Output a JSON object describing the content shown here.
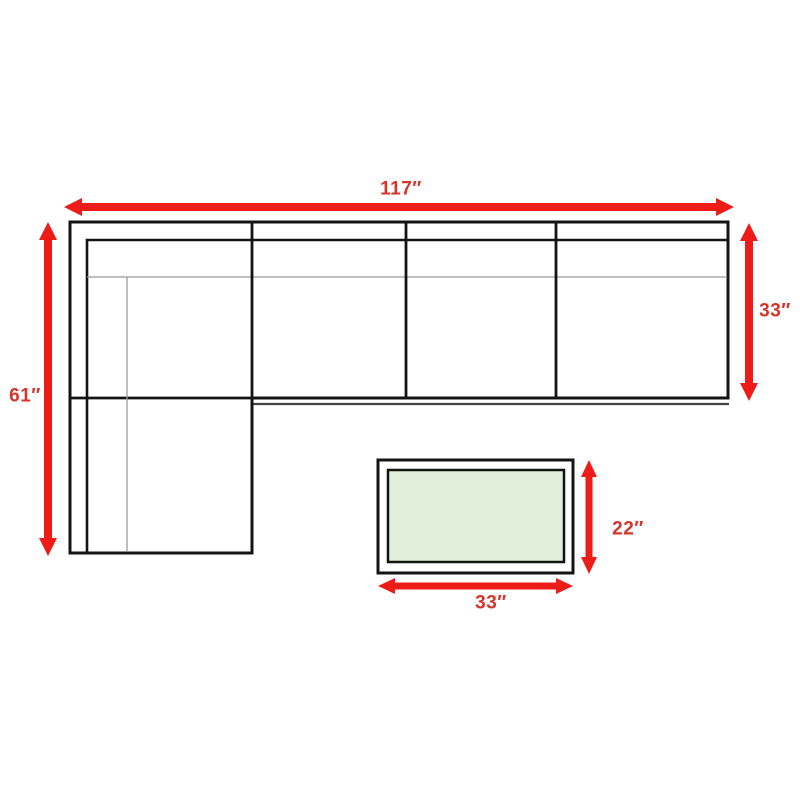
{
  "diagram": {
    "type": "furniture-dimension-diagram",
    "view": "top-down",
    "sofa": {
      "name": "sectional-sofa",
      "shape": "L-shaped",
      "seat_sections": 4,
      "width_label": "117″",
      "width_in": 117,
      "left_depth_label": "61″",
      "left_depth_in": 61,
      "right_depth_label": "33″",
      "right_depth_in": 33
    },
    "table": {
      "name": "coffee-table",
      "width_label": "33″",
      "width_in": 33,
      "depth_label": "22″",
      "depth_in": 22
    }
  },
  "colors": {
    "arrow_red": "#ee1c18",
    "label_red": "#d6352b",
    "line_black": "#141414",
    "thin_line_gray": "#9b9b9b",
    "table_green": "#e2efda",
    "background": "#ffffff"
  }
}
